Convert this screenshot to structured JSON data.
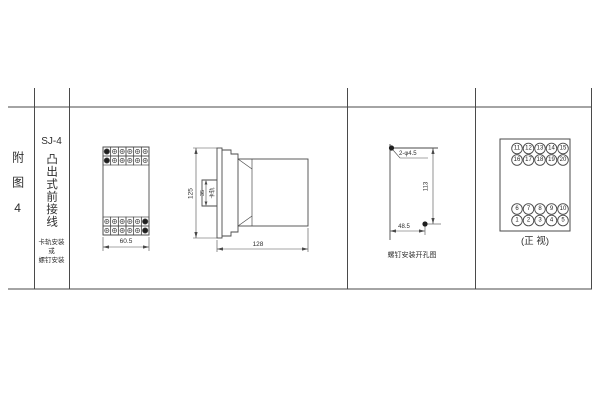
{
  "colors": {
    "line": "#4a4a4a",
    "fill_dark": "#1f1f1f",
    "bg": "#ffffff",
    "text": "#2e2e2e"
  },
  "row_label": {
    "text": "附图4"
  },
  "type_column": {
    "model": "SJ-4",
    "name_vertical": "凸出式前接线",
    "mount_note": [
      "卡轨安装",
      "或",
      "螺钉安装"
    ]
  },
  "front_view": {
    "width_dim": "60.5",
    "terminal_cols": 6,
    "terminal_rows": 2,
    "filled_top_col": 0,
    "filled_bottom_col": 5
  },
  "side_view": {
    "height_dim": "125",
    "depth_dim": "128",
    "rail_dim": "35",
    "rail_label": "卡轨"
  },
  "drill_view": {
    "holes_label": "2-φ4.5",
    "vertical_dim": "113",
    "horizontal_dim": "48.5",
    "caption": "螺钉安装开孔图"
  },
  "terminal_view": {
    "caption": "(正 视)",
    "rows": [
      [
        "11",
        "12",
        "13",
        "14",
        "15"
      ],
      [
        "16",
        "17",
        "18",
        "19",
        "20"
      ],
      [
        "6",
        "7",
        "8",
        "9",
        "10"
      ],
      [
        "1",
        "2",
        "3",
        "4",
        "5"
      ]
    ]
  }
}
